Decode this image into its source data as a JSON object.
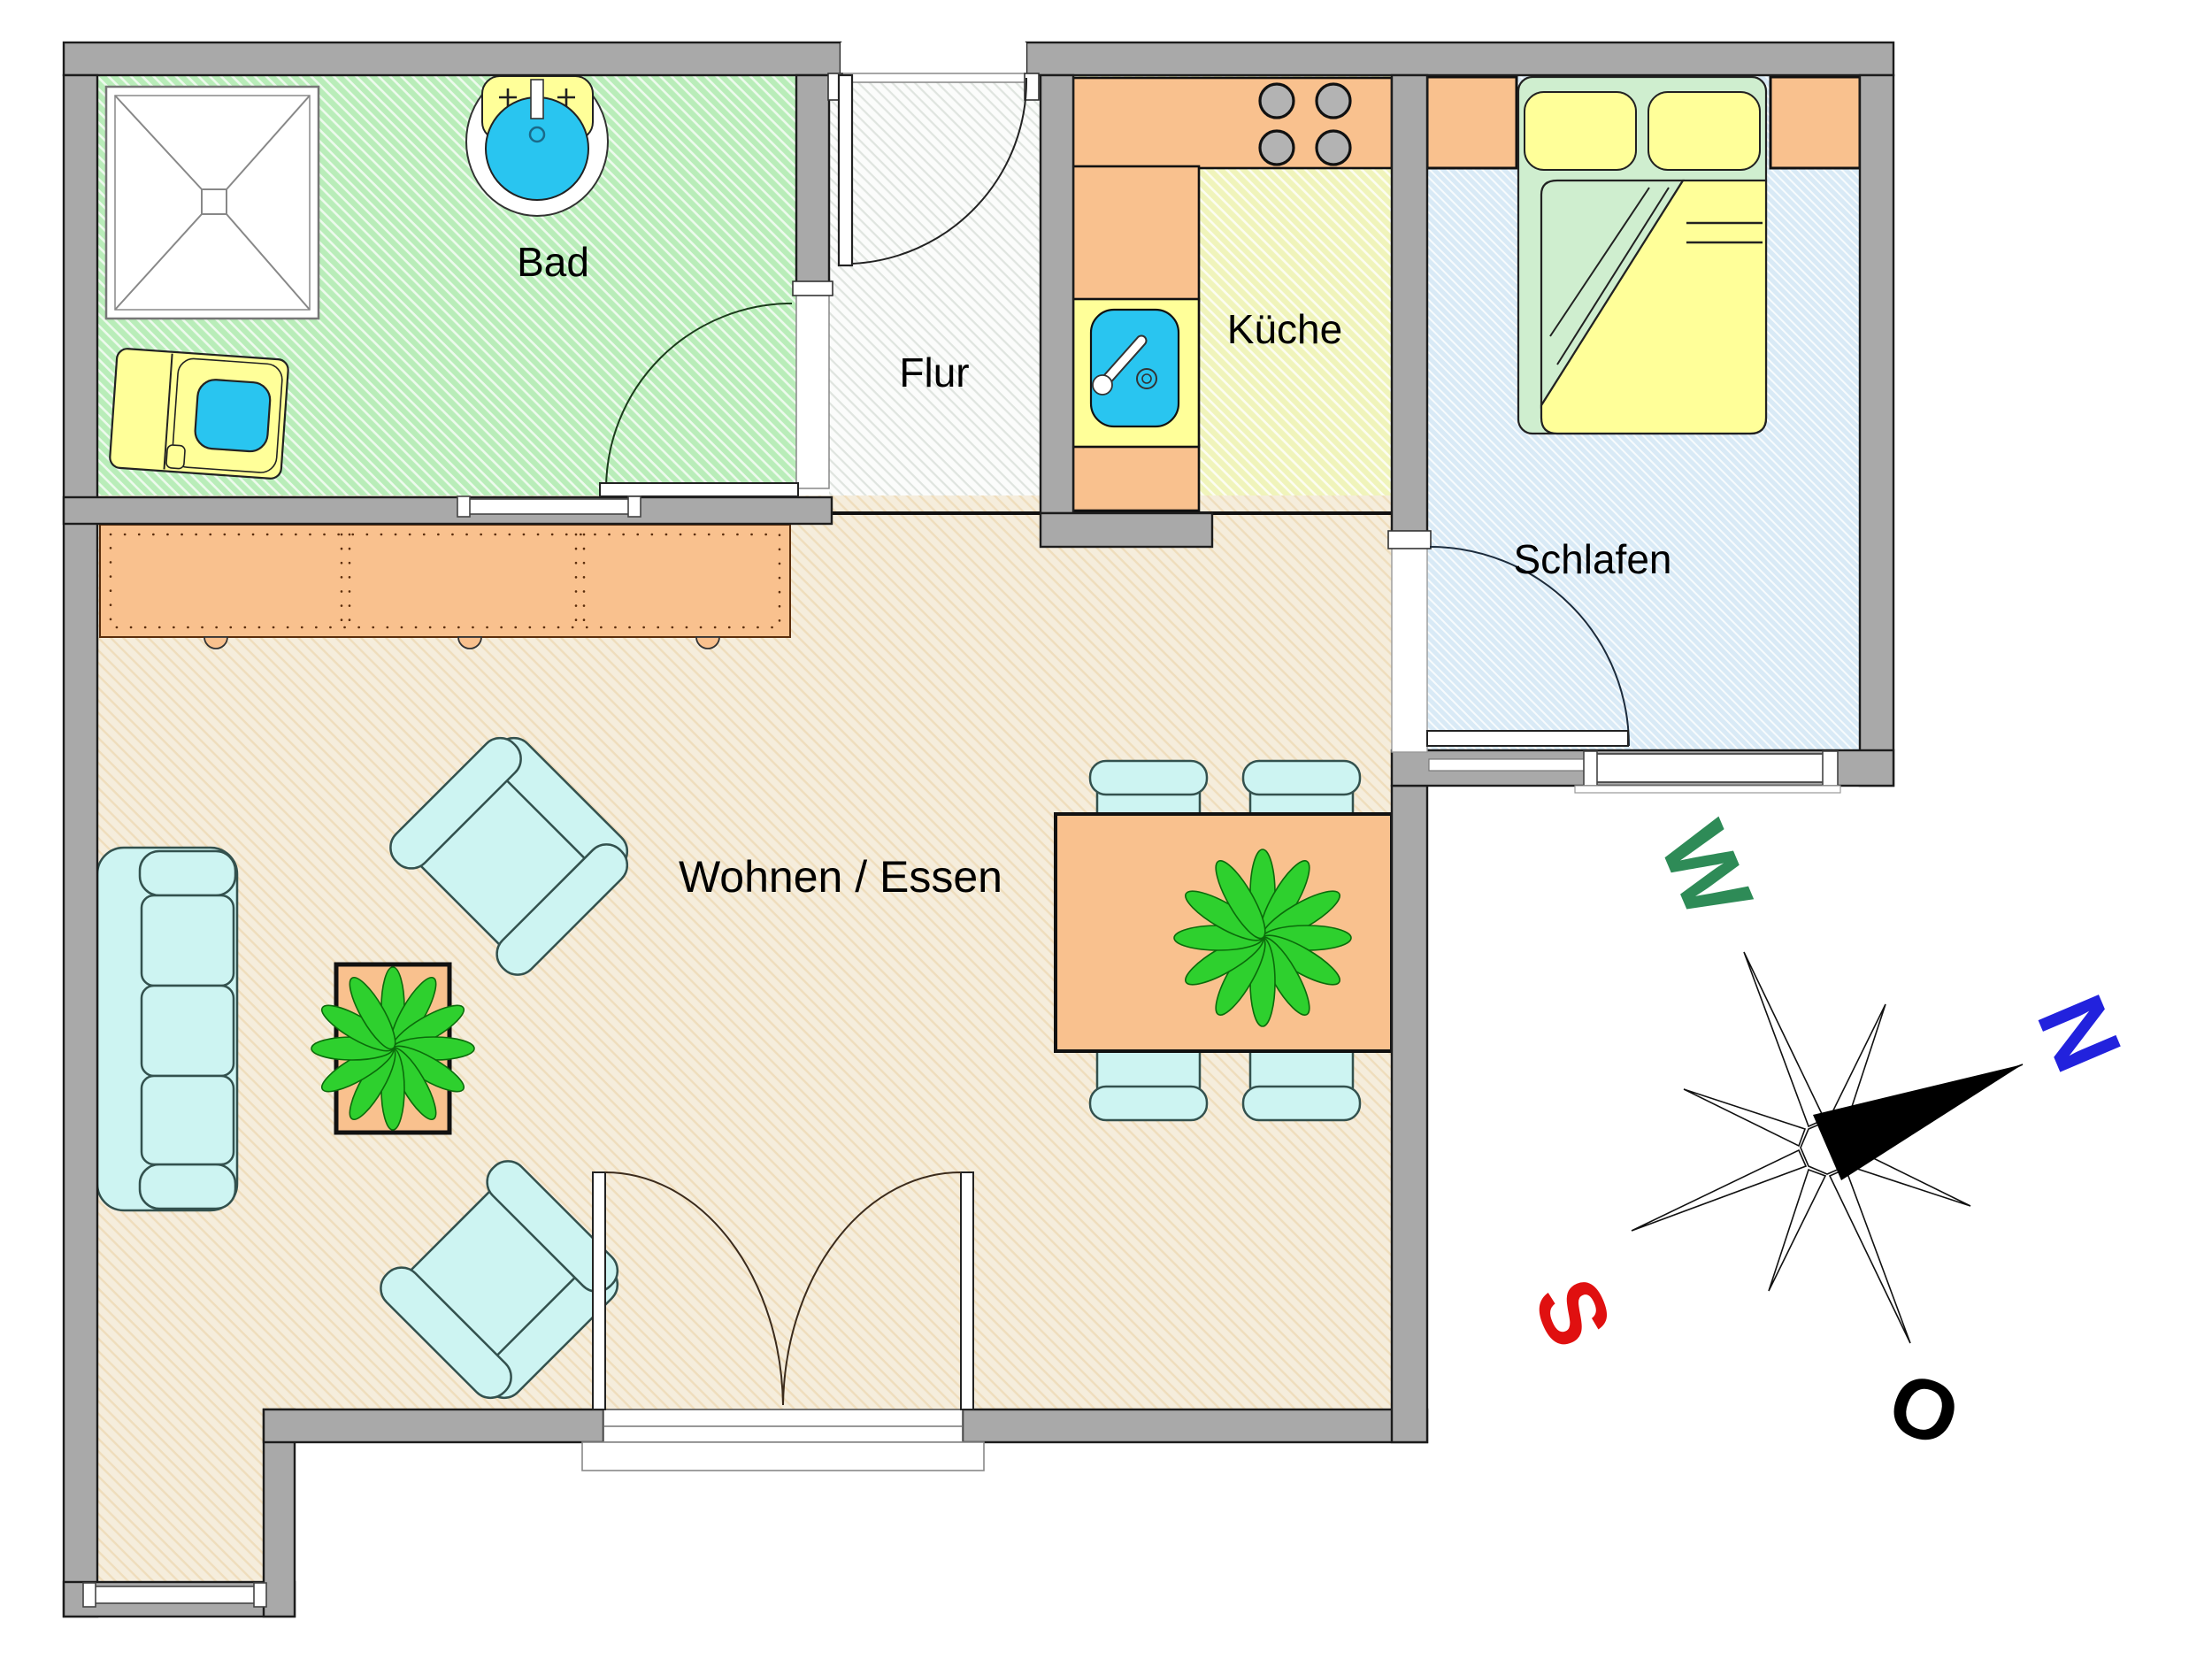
{
  "plan": {
    "type": "floorplan",
    "rooms": [
      {
        "id": "bad",
        "label": "Bad"
      },
      {
        "id": "flur",
        "label": "Flur"
      },
      {
        "id": "kueche",
        "label": "Küche"
      },
      {
        "id": "schlafen",
        "label": "Schlafen"
      },
      {
        "id": "wohnen",
        "label": "Wohnen / Essen"
      }
    ],
    "compass": {
      "n": {
        "label": "N",
        "color": "#2222dd"
      },
      "w": {
        "label": "W",
        "color": "#2e8b57"
      },
      "s": {
        "label": "S",
        "color": "#e01010"
      },
      "o": {
        "label": "O",
        "color": "#000000"
      }
    },
    "colors": {
      "wall_gray": "#a9a9a9",
      "floor_bad_green": "#b9edb9",
      "floor_flur_white": "#fbfcfb",
      "floor_kueche_yellow": "#f6f8cb",
      "floor_schlafen_blue": "#d9eaf6",
      "floor_wohnen_beige": "#f5eddc",
      "furniture_orange": "#f9c18e",
      "furniture_cyan": "#cdf4f2",
      "furniture_yellow": "#ffff99",
      "water_blue": "#29c5f0",
      "plant_green": "#2ed02e",
      "bed_green": "#cfeecf",
      "burner_gray": "#b3b3b3"
    }
  }
}
